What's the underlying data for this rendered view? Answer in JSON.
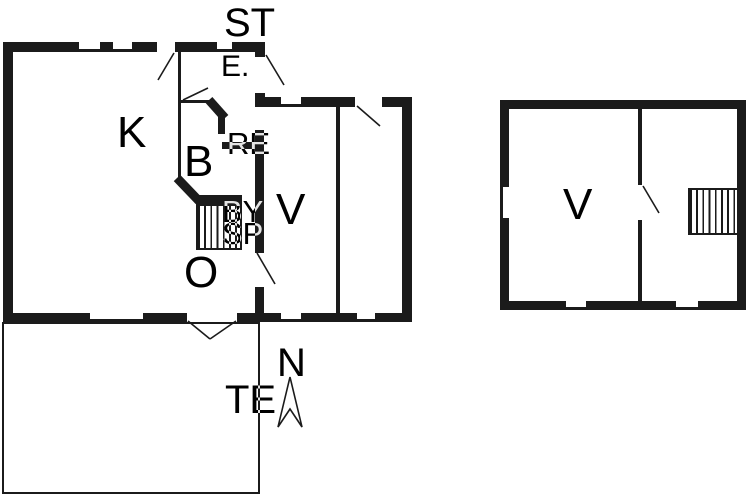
{
  "floorplan": {
    "colors": {
      "wall": "#1b1b1b",
      "background": "#ffffff"
    },
    "main_building": {
      "labels": {
        "st": "ST",
        "entrance": "E.",
        "kitchen": "K",
        "bath": "B",
        "re": "RE",
        "by": "BY",
        "sp": "SP",
        "room_v": "V",
        "living": "O",
        "terrace": "TE"
      }
    },
    "annex_building": {
      "labels": {
        "room_v": "V"
      }
    },
    "compass": {
      "north": "N"
    }
  }
}
